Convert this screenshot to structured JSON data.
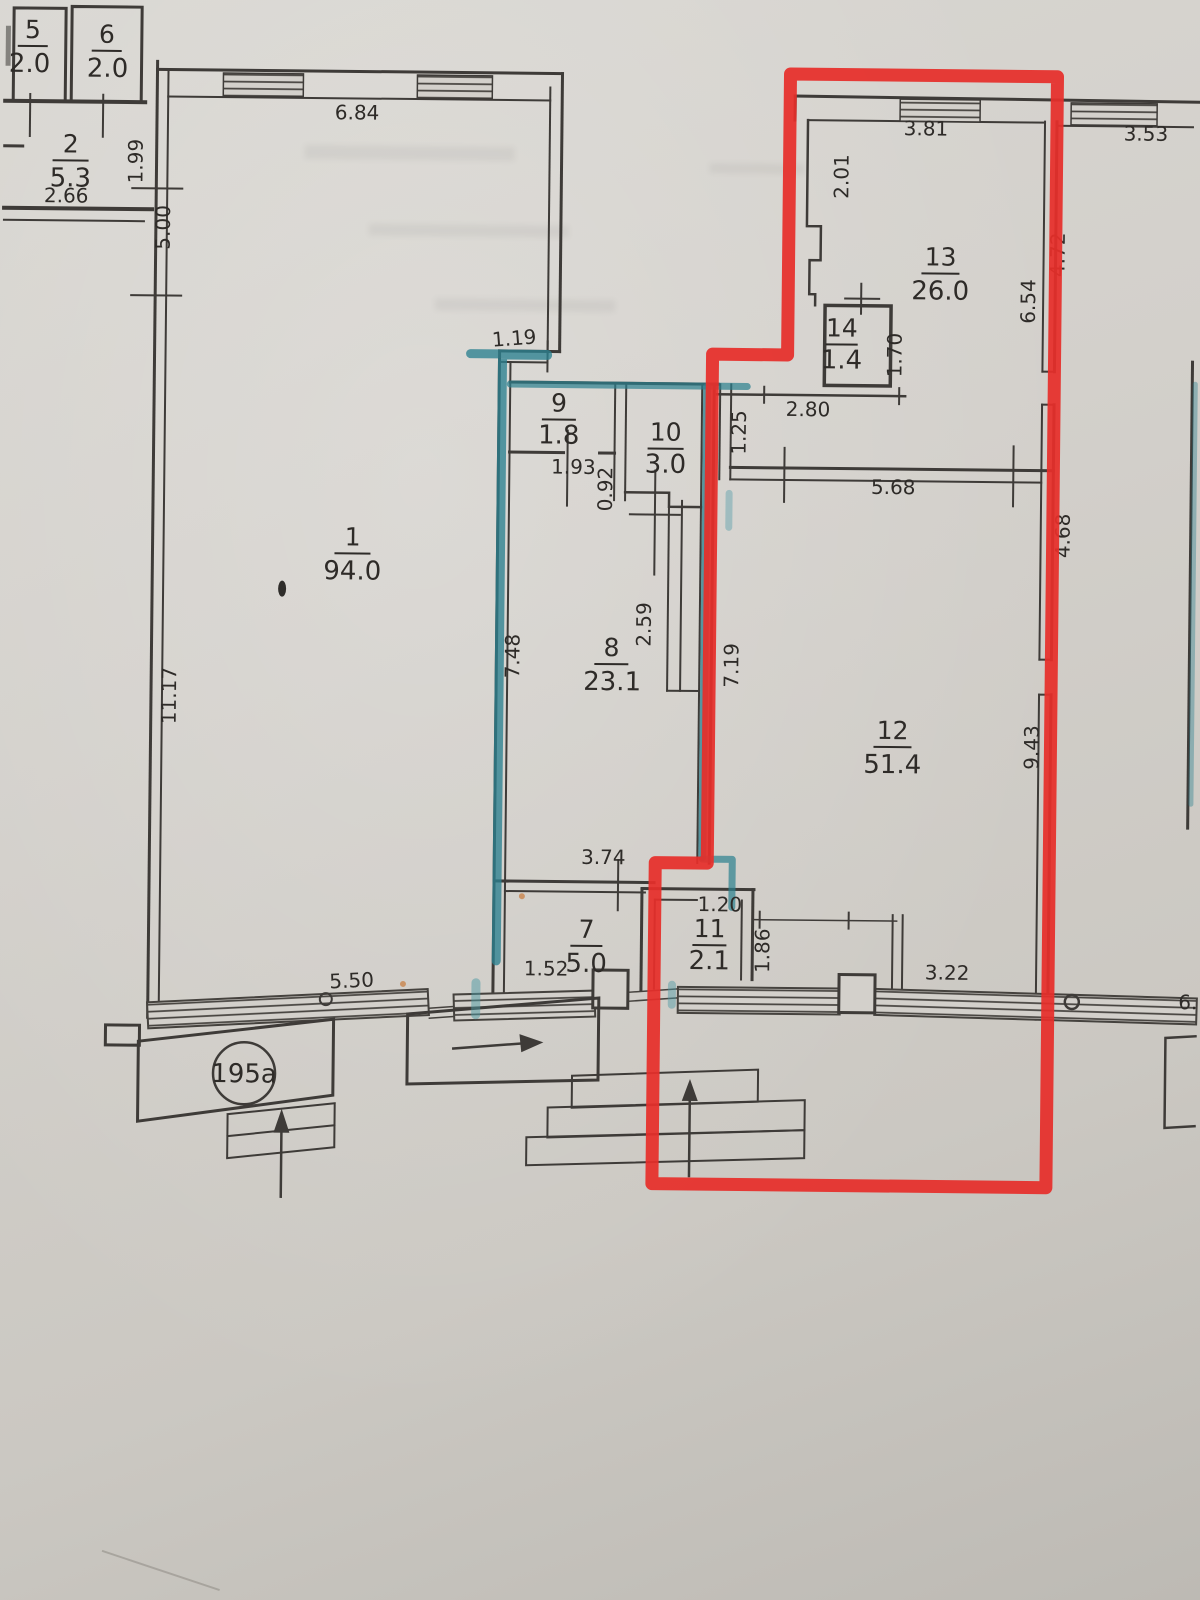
{
  "unit_label": "195a",
  "rooms": {
    "r1": {
      "number": "1",
      "area": "94.0"
    },
    "r2": {
      "number": "2",
      "area": "5.3"
    },
    "r5": {
      "number": "5",
      "area": "2.0"
    },
    "r6": {
      "number": "6",
      "area": "2.0"
    },
    "r7": {
      "number": "7",
      "area": "5.0"
    },
    "r8": {
      "number": "8",
      "area": "23.1"
    },
    "r9": {
      "number": "9",
      "area": "1.8"
    },
    "r10": {
      "number": "10",
      "area": "3.0"
    },
    "r11": {
      "number": "11",
      "area": "2.1"
    },
    "r12": {
      "number": "12",
      "area": "51.4"
    },
    "r13": {
      "number": "13",
      "area": "26.0"
    },
    "r14": {
      "number": "14",
      "area": "1.4"
    }
  },
  "dims": {
    "top_wall_room1": "6.84",
    "top_wall_room13": "3.81",
    "top_wall_right": "3.53",
    "room13_left_upper": "2.01",
    "room2_right_upper": "1.99",
    "room2_right_lower": "5.00",
    "room2_width": "2.66",
    "room1_left": "11.17",
    "corridor_jog": "1.19",
    "room9_width": "1.93",
    "room9_offset": "0.92",
    "room8_niche": "2.59",
    "room8_left": "7.48",
    "room8_right_strip": "7.19",
    "room12_left_upper": "1.25",
    "room14_bottom": "2.80",
    "room12_top": "5.68",
    "room14_right": "1.70",
    "room13_right_inner": "6.54",
    "room13_right_outer": "4.72",
    "room12_right_upper": "4.68",
    "room12_right_lower": "9.43",
    "room7_top": "3.74",
    "room11_top": "1.20",
    "room11_right": "1.86",
    "room7_bottom_left": "1.52",
    "bottom_wall_left": "5.50",
    "bottom_wall_right": "3.22",
    "bottom_right_cut": "6."
  },
  "colors": {
    "red_outline": "#e62e2a",
    "teal_highlight": "#2b808f",
    "wall": "#3e3b38",
    "paper": "#d3d0cb"
  }
}
